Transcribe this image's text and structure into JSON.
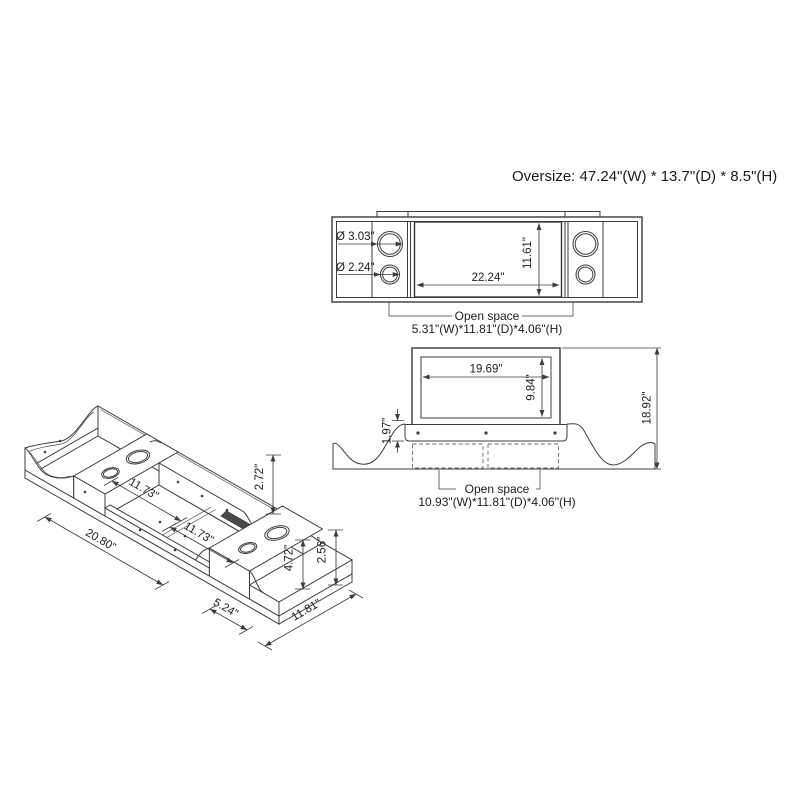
{
  "title": "Oversize: 47.24\"(W) * 13.7\"(D) * 8.5\"(H)",
  "top_view": {
    "dia_large": "Ø 3.03\"",
    "dia_small": "Ø 2.24\"",
    "inner_width": "22.24\"",
    "inner_depth": "11.61\"",
    "open_space_label": "Open space",
    "open_space_dims": "5.31\"(W)*11.81\"(D)*4.06\"(H)"
  },
  "front_view": {
    "opening_width": "19.69\"",
    "opening_height": "9.84\"",
    "strip_height": "1.97\"",
    "total_height": "18.92\"",
    "open_space_label": "Open space",
    "open_space_dims": "10.93\"(W)*11.81\"(D)*4.06\"(H)"
  },
  "iso_view": {
    "section1_length": "11.73\"",
    "section2_length": "11.73\"",
    "overall_length": "20.80\"",
    "back_wall_height": "2.72\"",
    "cup_panel_height": "4.72\"",
    "step_height": "2.56\"",
    "step_depth": "5.24\"",
    "unit_depth": "11.81\""
  },
  "colors": {
    "line": "#3d3d3d",
    "text": "#1c1c1c"
  }
}
